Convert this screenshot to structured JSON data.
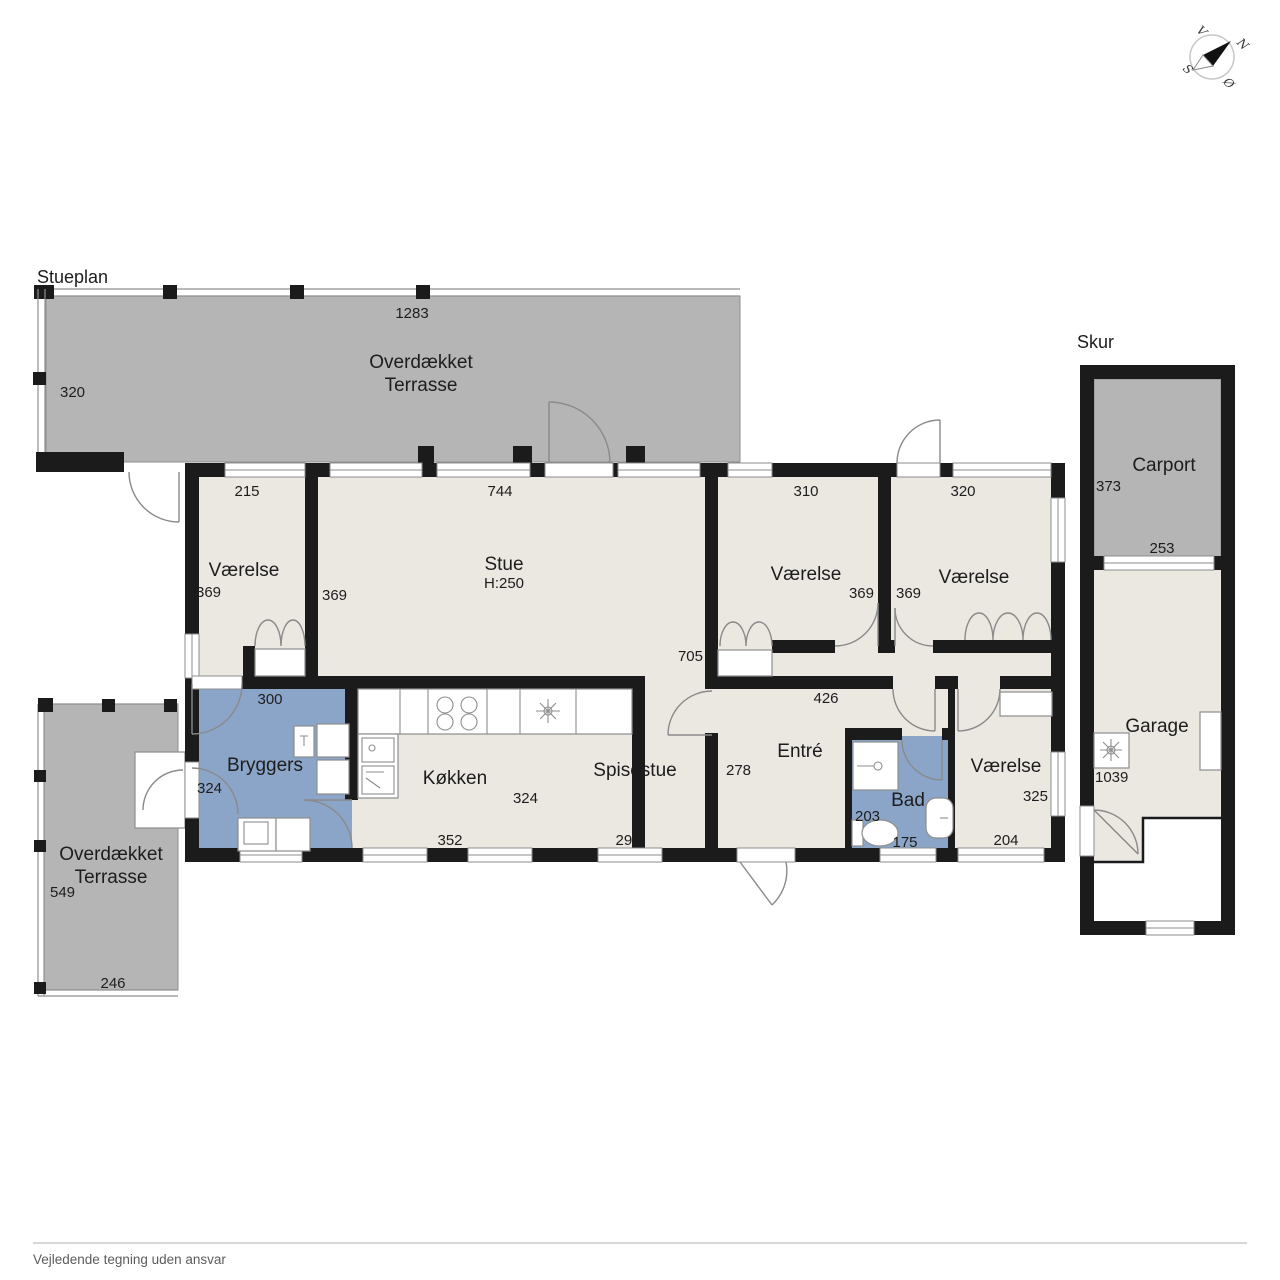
{
  "plan_title": "Stueplan",
  "footer_disclaimer": "Vejledende tegning uden ansvar",
  "compass": {
    "north": "N",
    "south": "S",
    "east": "Ø",
    "west": "V"
  },
  "outbuilding_title": "Skur",
  "rooms": {
    "terrace_top": {
      "name_line1": "Overdækket",
      "name_line2": "Terrasse",
      "dim_top": "1283",
      "dim_left": "320"
    },
    "vaerelse_nw": {
      "name": "Værelse",
      "dim_top": "215",
      "dim_left": "369"
    },
    "stue": {
      "name": "Stue",
      "ceiling_height": "H:250",
      "dim_top": "744",
      "dim_left": "369",
      "dim_depth": "705"
    },
    "vaerelse_n1": {
      "name": "Værelse",
      "dim_top": "310",
      "dim_right": "369"
    },
    "vaerelse_n2": {
      "name": "Værelse",
      "dim_top": "320",
      "dim_left": "369"
    },
    "bryggers": {
      "name": "Bryggers",
      "dim_top": "300",
      "dim_left": "324"
    },
    "koekken": {
      "name": "Køkken",
      "dim_right": "324",
      "dim_bottom": "352"
    },
    "spisestue": {
      "name": "Spisestue",
      "dim_bottom": "296",
      "dim_right": "278"
    },
    "entre": {
      "name": "Entré",
      "dim_top": "426"
    },
    "bad": {
      "name": "Bad",
      "dim_left": "203",
      "dim_bottom": "175"
    },
    "vaerelse_se": {
      "name": "Værelse",
      "dim_right": "325",
      "dim_bottom": "204"
    },
    "terrace_sw": {
      "name_line1": "Overdækket",
      "name_line2": "Terrasse",
      "dim_left": "549",
      "dim_bottom": "246"
    },
    "carport": {
      "name": "Carport",
      "dim_left": "373",
      "dim_bottom": "253"
    },
    "garage": {
      "name": "Garage",
      "dim_left": "1039"
    }
  },
  "colors": {
    "wall": "#1b1b1b",
    "terrace_gray": "#b5b5b5",
    "floor_beige": "#ebe7e1",
    "wet_room_blue": "#8ba5c9"
  }
}
